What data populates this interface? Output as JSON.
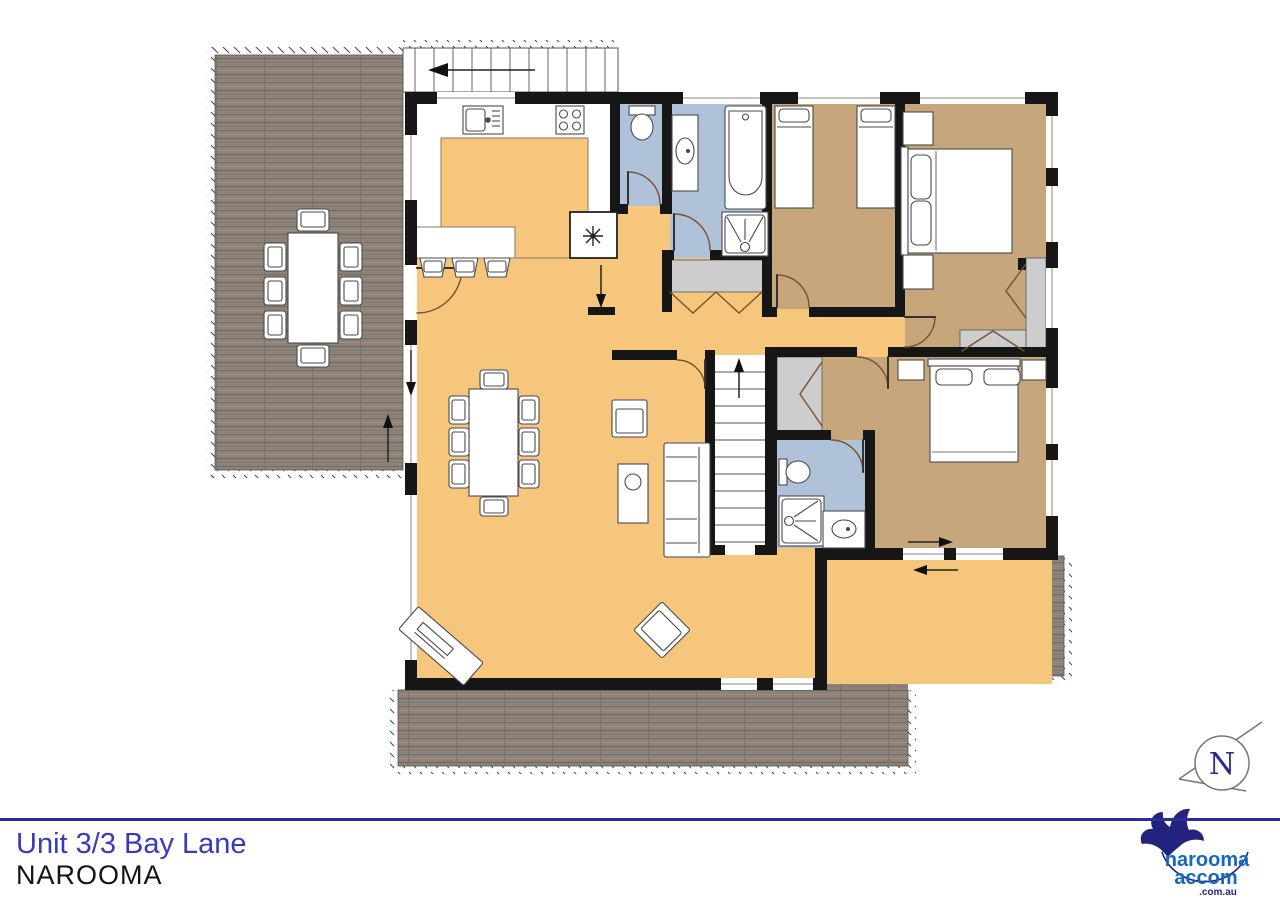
{
  "footer": {
    "address": "Unit 3/3 Bay Lane",
    "locality": "NAROOMA"
  },
  "north_indicator": {
    "label": "N"
  },
  "logo": {
    "brand_top": "narooma",
    "brand_bottom": "accom",
    "domain": ".com.au"
  },
  "colors": {
    "living_floor_orange": "#F7C67D",
    "bedroom_floor_tan": "#C6A67A",
    "bathroom_floor_blue": "#AFC2D9",
    "closet_gray": "#CDCDCD",
    "deck_wood": "#8D8278",
    "wall_black": "#161616",
    "door_arc_brown": "#7A5230",
    "rule_blue": "#2B2BA6",
    "address_blue": "#3A3ABD",
    "logo_navy": "#23237E",
    "logo_blue": "#1567C0"
  }
}
